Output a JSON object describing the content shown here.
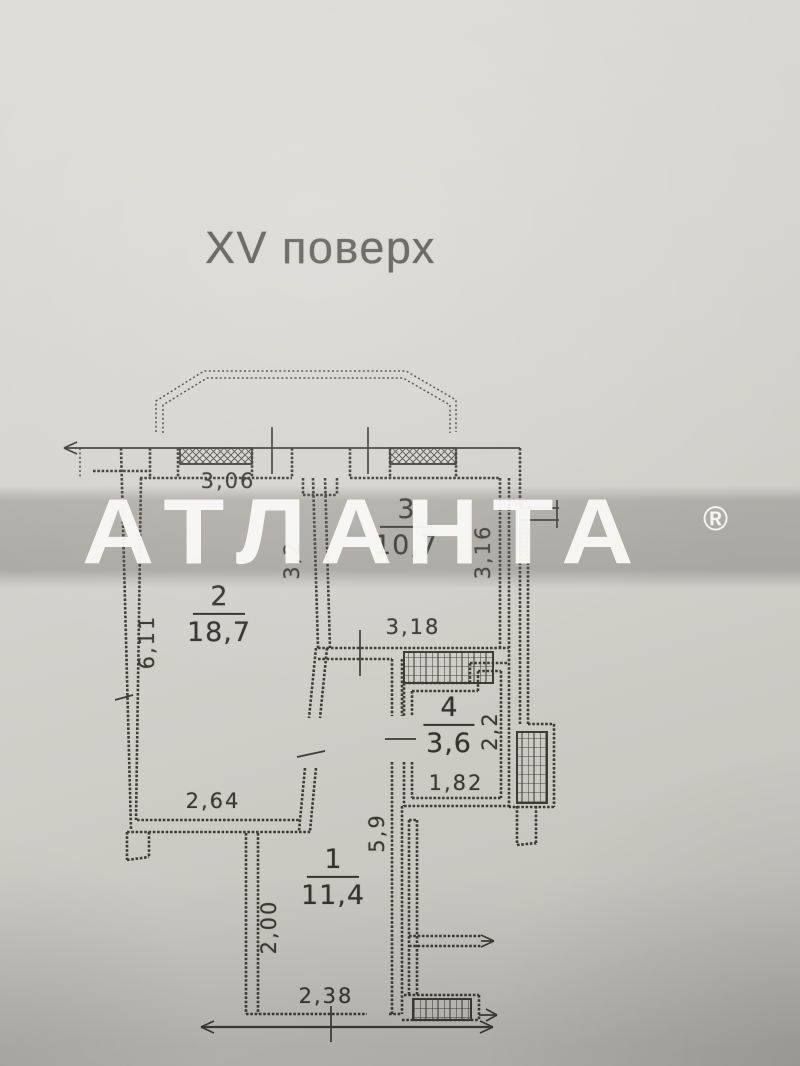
{
  "title": {
    "text": "XV поверх"
  },
  "watermark": {
    "brand": "АТЛАНТА",
    "registered_mark": "®"
  },
  "floorplan": {
    "rooms": [
      {
        "number": "1",
        "area": "11,4"
      },
      {
        "number": "2",
        "area": "18,7"
      },
      {
        "number": "3",
        "area": "10,7"
      },
      {
        "number": "4",
        "area": "3,6"
      }
    ],
    "dimensions": [
      {
        "value": "3,06",
        "orientation": "horizontal"
      },
      {
        "value": "6,11",
        "orientation": "vertical"
      },
      {
        "value": "3,2",
        "orientation": "vertical"
      },
      {
        "value": "3,18",
        "orientation": "horizontal"
      },
      {
        "value": "3,16",
        "orientation": "vertical"
      },
      {
        "value": "2,64",
        "orientation": "horizontal"
      },
      {
        "value": "2,2",
        "orientation": "vertical"
      },
      {
        "value": "1,82",
        "orientation": "horizontal"
      },
      {
        "value": "5,9",
        "orientation": "vertical"
      },
      {
        "value": "2,00",
        "orientation": "vertical"
      },
      {
        "value": "2,38",
        "orientation": "horizontal"
      }
    ]
  }
}
